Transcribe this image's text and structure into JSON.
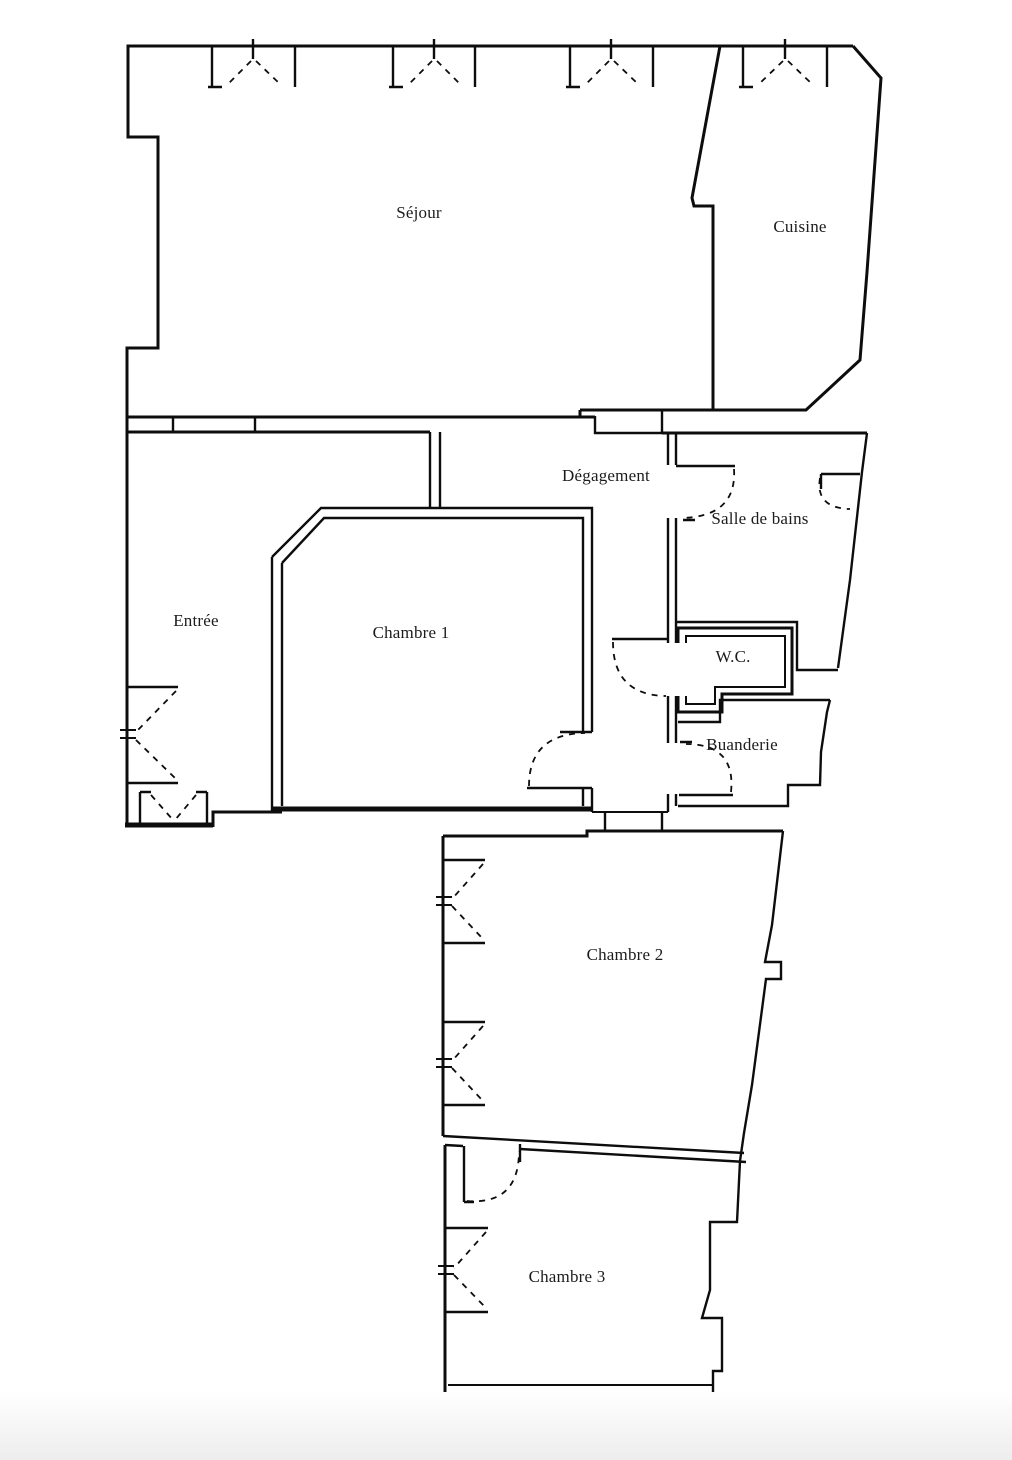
{
  "document": {
    "type": "floor-plan",
    "background_color": "#ffffff",
    "wall_color": "#0d0d0d",
    "label_color": "#1c1c1c",
    "footer_strip_color": "#ededed"
  },
  "rooms": [
    {
      "name": "Séjour",
      "x": 419,
      "y": 213
    },
    {
      "name": "Cuisine",
      "x": 800,
      "y": 227
    },
    {
      "name": "Dégagement",
      "x": 606,
      "y": 476
    },
    {
      "name": "Salle de bains",
      "x": 760,
      "y": 519
    },
    {
      "name": "Entrée",
      "x": 196,
      "y": 621
    },
    {
      "name": "Chambre 1",
      "x": 411,
      "y": 633
    },
    {
      "name": "W.C.",
      "x": 733,
      "y": 657
    },
    {
      "name": "Buanderie",
      "x": 742,
      "y": 745
    },
    {
      "name": "Chambre 2",
      "x": 625,
      "y": 955
    },
    {
      "name": "Chambre 3",
      "x": 567,
      "y": 1277
    }
  ]
}
